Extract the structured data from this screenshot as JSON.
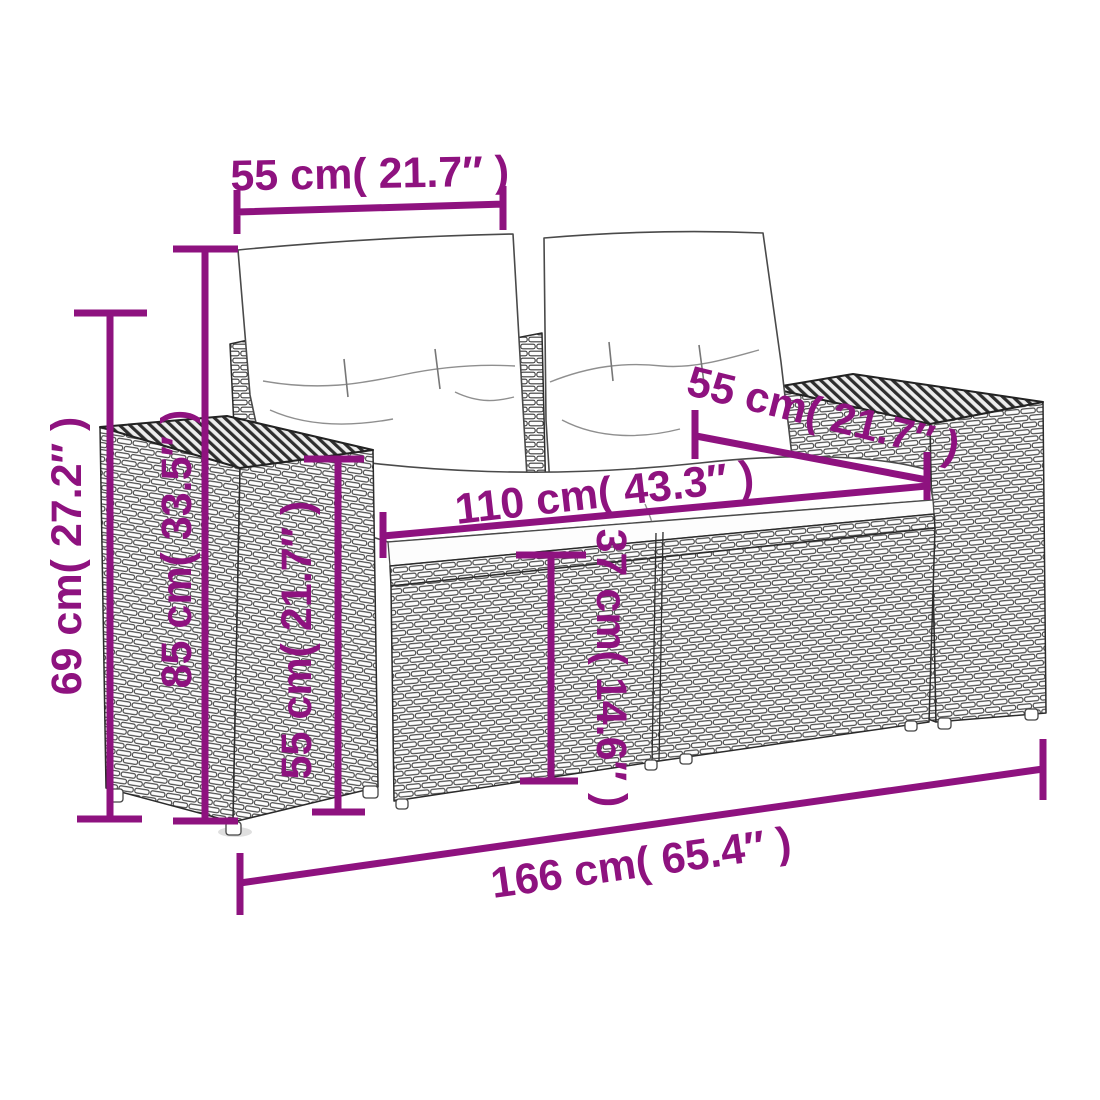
{
  "diagram": {
    "subject": "poly rattan garden loveseat with back and seat cushions",
    "style": {
      "accent_color": "#8e127f",
      "line_art_color": "#2b2b2b",
      "background": "#ffffff"
    },
    "dimensions": [
      {
        "id": "backrest-cushion-width",
        "label": "55 cm( 21.7″ )"
      },
      {
        "id": "armrest-height",
        "label": "69 cm( 27.2″ )"
      },
      {
        "id": "backrest-height",
        "label": "85 cm( 33.5″ )"
      },
      {
        "id": "arm-top-height",
        "label": "55 cm( 21.7″ )"
      },
      {
        "id": "seat-height",
        "label": "37 cm( 14.6″ )"
      },
      {
        "id": "seat-depth",
        "label": "55 cm( 21.7″ )"
      },
      {
        "id": "seat-width",
        "label": "110 cm( 43.3″ )"
      },
      {
        "id": "overall-width",
        "label": "166 cm( 65.4″ )"
      }
    ]
  }
}
